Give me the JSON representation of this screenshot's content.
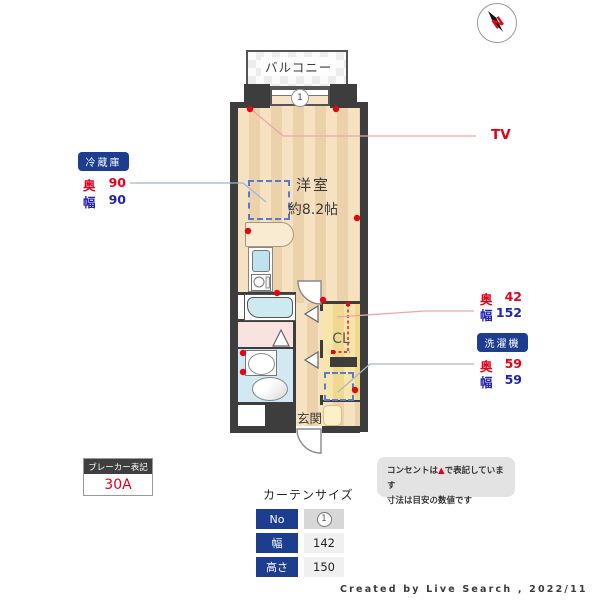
{
  "plan": {
    "balcony_label": "バルコニー",
    "room_label": "洋室",
    "room_size": "約8.2帖",
    "closet_label": "CL",
    "entrance_label": "玄関",
    "window_no": "1",
    "compass_n": "N"
  },
  "annotations": {
    "fridge": {
      "title": "冷蔵庫",
      "depth_label": "奥",
      "depth": "90",
      "width_label": "幅",
      "width": "90"
    },
    "tv_label": "TV",
    "closet_dims": {
      "depth_label": "奥",
      "depth": "42",
      "width_label": "幅",
      "width": "152"
    },
    "washer": {
      "title": "洗濯機",
      "depth_label": "奥",
      "depth": "59",
      "width_label": "幅",
      "width": "59"
    },
    "breaker": {
      "title": "ブレーカー表記",
      "value": "30A"
    }
  },
  "curtain": {
    "title": "カーテンサイズ",
    "rows": [
      {
        "label": "No",
        "value": "1"
      },
      {
        "label": "幅",
        "value": "142"
      },
      {
        "label": "高さ",
        "value": "150"
      }
    ]
  },
  "note": {
    "line1_pre": "コンセントは",
    "line1_mark": "▲",
    "line1_post": "で表記しています",
    "line2": "寸法は目安の数値です"
  },
  "credit": "Created by Live Search , 2022/11",
  "colors": {
    "wall": "#3d3d3d",
    "badge_navy": "#1d3d8f",
    "outlet_red": "#e30613",
    "dim_red": "#e60018",
    "dim_blue": "#2222b4"
  }
}
